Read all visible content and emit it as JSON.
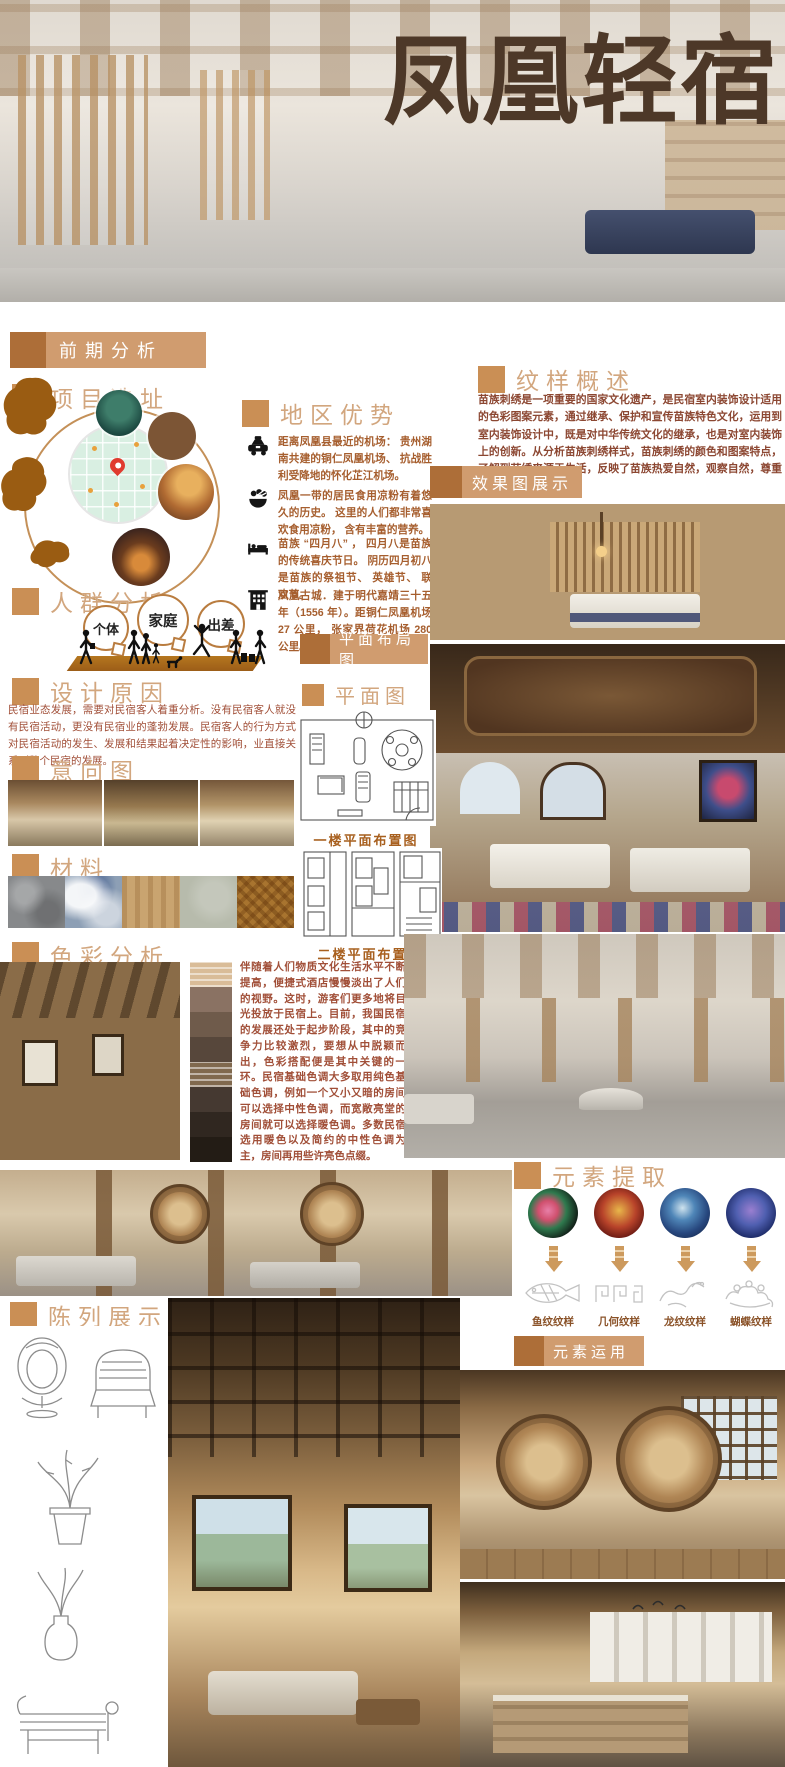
{
  "title": "凤凰轻宿",
  "palette": {
    "title_brown": "#4d3828",
    "badge_square": "#ad6e38",
    "badge_bar": "#d09c6f",
    "header_square": "#ca8f55",
    "header_text": "#d2a67e",
    "body_orange": "#a65e2e",
    "body_red_brown": "#a14f38",
    "map_shape_brown": "#9a5c12",
    "platform_brown": "#a9671f",
    "pin_red": "#e03b2f"
  },
  "badges": {
    "qianqi": "前期分析",
    "xiaoguotu": "效果图展示",
    "pingmian_buju": "平面布局图",
    "yuansu_yunyong": "元素运用"
  },
  "headers": {
    "xiangmu_xuanzhi": "项目选址",
    "diqu_youshi": "地区优势",
    "renqun_fenxi": "人群分析",
    "sheji_yuanyin": "设计原因",
    "yixiangtu": "意向图",
    "cailiao": "材料",
    "secai_fenxi": "色彩分析",
    "wenyang_gaishu": "纹样概述",
    "pingmiantu": "平面图",
    "yuansu_tiqu": "元素提取",
    "chenlie_zhanshi": "陈列展示"
  },
  "region_items": [
    {
      "icon": "taxi-icon",
      "text": "距离凤凰县最近的机场： 贵州湖南共建的铜仁凤凰机场、 抗战胜利受降地的怀化芷江机场。"
    },
    {
      "icon": "food-icon",
      "text": "凤凰一带的居民食用凉粉有着悠久的历史。 这里的人们都非常喜欢食用凉粉， 含有丰富的营养。"
    },
    {
      "icon": "bed-icon",
      "text": "苗族 “四月八” ， 四月八是苗族的传统喜庆节日。 阴历四月初八是苗族的祭祖节、 英雄节、 联欢节。"
    },
    {
      "icon": "building-icon",
      "text": "凤凰古城．建于明代嘉靖三十五年（1556 年）。距铜仁凤凰机场 27 公里， 张家界荷花机场 280 公里。"
    }
  ],
  "crowd_bubbles": [
    "个体",
    "家庭",
    "出差"
  ],
  "design_reason_text": "民宿业态发展，需要对民宿客人着重分析。没有民宿客人就没有民宿活动，更没有民宿业的蓬勃发展。民宿客人的行为方式对民宿活动的发生、发展和结果起着决定性的影响，业直接关系到整个民宿的发展。",
  "pattern_overview_text": "苗族刺绣是一项重要的国家文化遗产，是民宿室内装饰设计适用的色彩图案元素，通过继承、保护和宣传苗族特色文化，运用到室内装饰设计中，既是对中华传统文化的继承，也是对室内装饰上的创新。从分析苗族刺绣样式，苗族刺绣的颜色和图案特点，了解到苗绣来源于生活，反映了苗族热爱自然，观察自然，尊重自然的单纯宇宙论。",
  "color_analysis_text": "伴随着人们物质文化生活水平不断提高，便捷式酒店慢慢淡出了人们的视野。这时，游客们更多地将目光投放于民宿上。目前，我国民宿的发展还处于起步阶段，其中的竞争力比较激烈，要想从中脱颖而出，色彩搭配便是其中关键的一环。民宿基础色调大多取用纯色基础色调，例如一个又小又暗的房间可以选择中性色调，而宽敞亮堂的房间就可以选择暖色调。多数民宿选用暖色以及简约的中性色调为主，房间再用些许亮色点缀。",
  "plan_captions": {
    "floor1": "一楼平面布置图",
    "floor2": "二楼平面布置图"
  },
  "pattern_labels": [
    "鱼纹纹样",
    "几何纹样",
    "龙纹纹样",
    "蝴蝶纹样"
  ],
  "material_swatches": [
    "#87898b",
    "#8d9fb5",
    "#c9a470",
    "#b7bbac",
    "#a8742f"
  ],
  "color_swatches": [
    "#d9bc98",
    "#8a7263",
    "#6f5b4b",
    "#57473b",
    "#80694e",
    "#453931",
    "#302720",
    "#231c15"
  ]
}
